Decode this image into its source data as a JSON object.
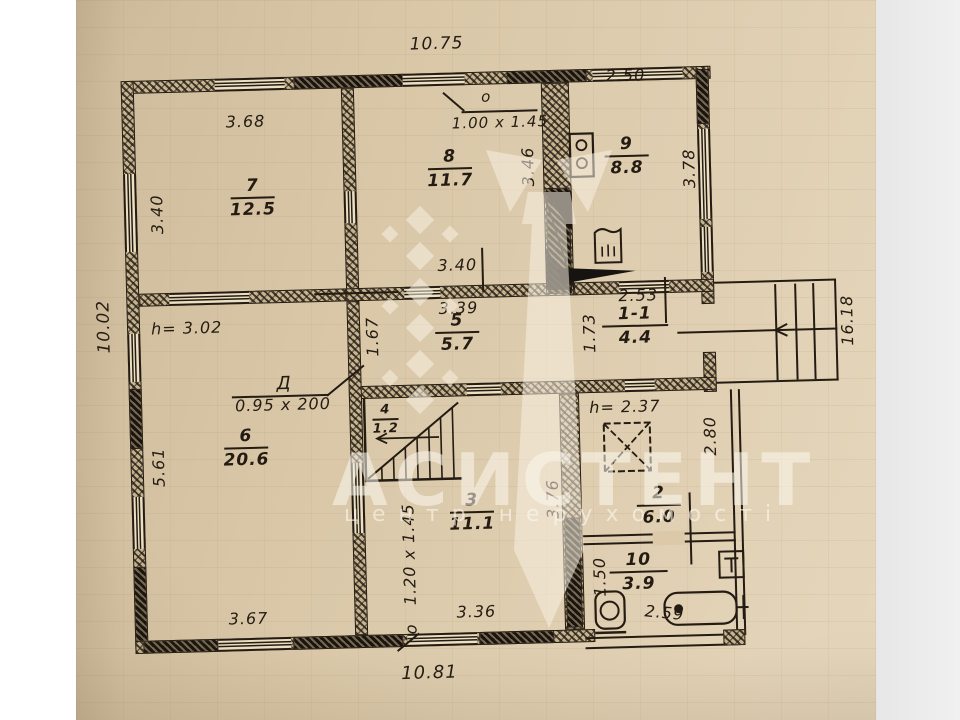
{
  "watermark": {
    "brand": "АСИСТЕНТ",
    "tagline": "центр нерухомості"
  },
  "rooms": [
    {
      "num": "7",
      "area": "12.5"
    },
    {
      "num": "8",
      "area": "11.7"
    },
    {
      "num": "9",
      "area": "8.8"
    },
    {
      "num": "5",
      "area": "5.7"
    },
    {
      "num": "1-1",
      "area": "4.4"
    },
    {
      "num": "6",
      "area": "20.6"
    },
    {
      "num": "4",
      "area": "1.2"
    },
    {
      "num": "3",
      "area": "11.1"
    },
    {
      "num": "2",
      "area": "6.0"
    },
    {
      "num": "10",
      "area": "3.9"
    }
  ],
  "dims": {
    "top": "10.75",
    "top_right": "2.50",
    "bottom": "10.81",
    "left": "10.02",
    "r7w": "3.68",
    "r7h": "3.40",
    "r8h": "3.46",
    "r9h": "3.78",
    "corr_a": "3.40",
    "corr_b": "3.39",
    "r5h": "1.67",
    "r11w": "2.53",
    "r11h": "1.73",
    "porch": "16.18",
    "r6h": "5.61",
    "r6w": "3.67",
    "r3w": "3.36",
    "r3h": "3.76",
    "annex": "2.80",
    "r10h": "1.50",
    "bath": "2.59"
  },
  "heights": {
    "h1": "h= 3.02",
    "h2": "h= 2.37"
  },
  "openings": {
    "door": {
      "label": "Д",
      "size": "0.95 x 200"
    },
    "win_top": {
      "label": "о",
      "size": "1.00 x 1.45"
    },
    "win_bot": {
      "label": "о",
      "size": "1.20 x 1.45"
    }
  }
}
